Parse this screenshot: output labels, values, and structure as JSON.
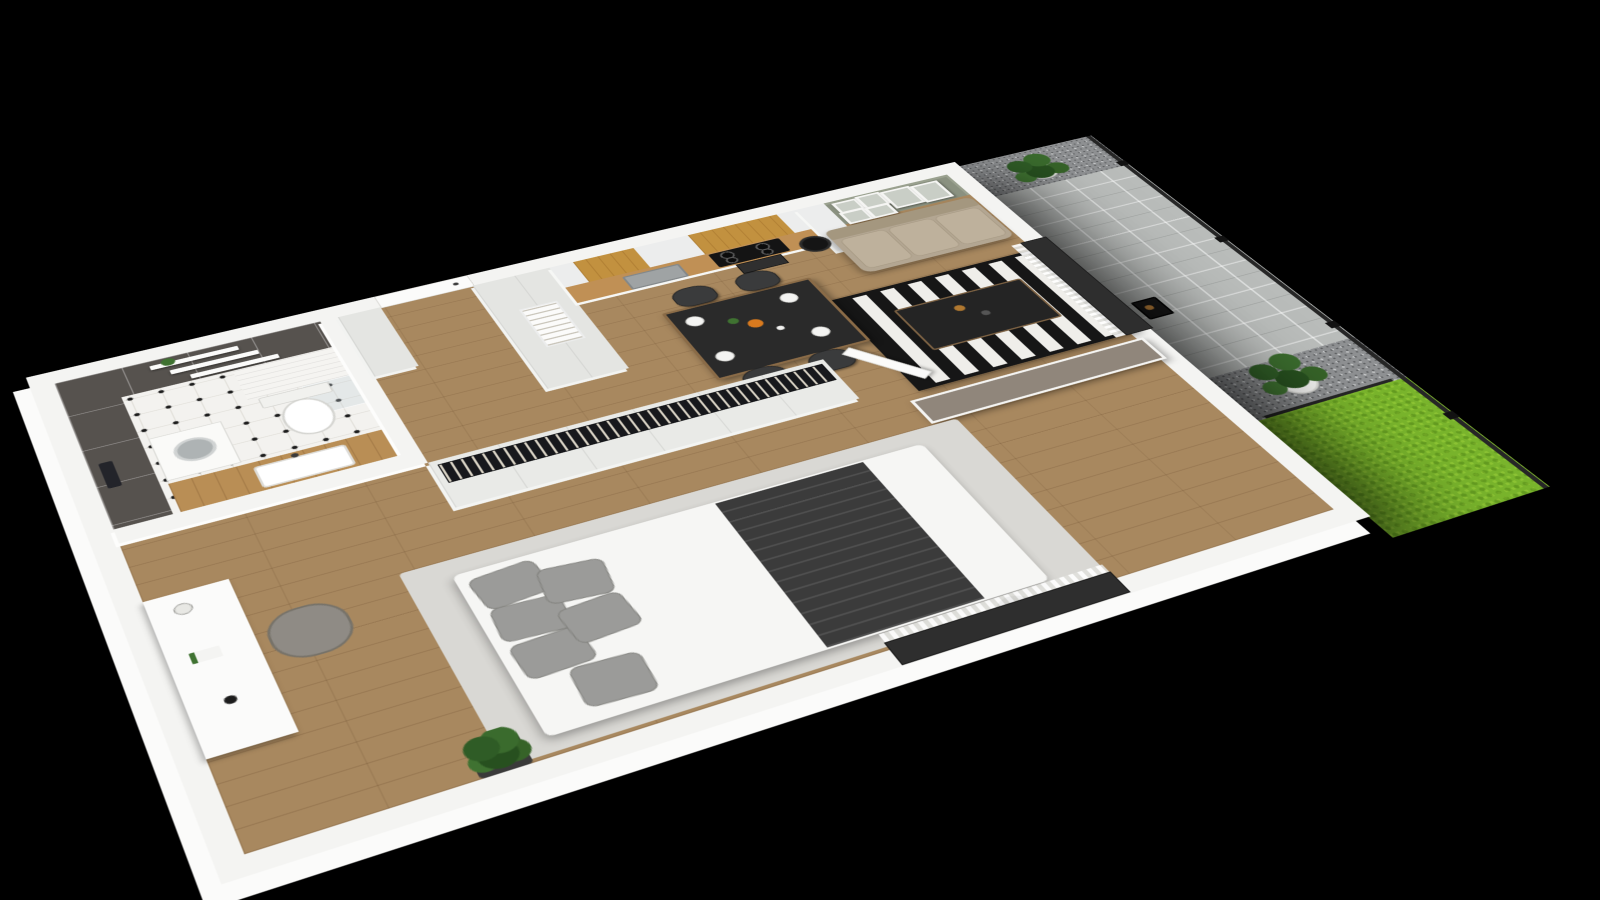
{
  "scene": {
    "type": "3d-isometric-floorplan-render",
    "description": "Photorealistic cutaway 3D floor plan of a one-bedroom apartment with terrace garden, viewed from above at an angle on a black background",
    "background": "#000000"
  },
  "palette": {
    "background_black": "#000000",
    "wall_white": "#f4f4f2",
    "floor_wood": "#a8885f",
    "tile_dark_grey": "#56524e",
    "bath_floor_white": "#f3f2ef",
    "cabinet_white": "#eceded",
    "cabinet_grey": "#e4e5e2",
    "oak_wood": "#c2913f",
    "counter_wood": "#b98e55",
    "sage_green_wall": "#8a9180",
    "sofa_beige": "#b3a692",
    "rug_black": "#161616",
    "rug_white": "#efeeea",
    "dining_charcoal": "#2a2a2a",
    "taupe_partition": "#90867b",
    "bed_linen_white": "#f6f6f4",
    "pillow_grey": "#9b9b99",
    "throw_charcoal": "#3b3b3b",
    "bed_rug_grey": "#d9d8d4",
    "chair_dark_grey": "#3a3b3c",
    "paving_grey": "#b9bcba",
    "gravel_grey": "#8e9092",
    "grass_green": "#79b42c",
    "plant_green": "#2f5c26",
    "pot_white": "#f2f2f0",
    "window_frame_dark": "#2e2e2e",
    "lantern_black": "#191919"
  },
  "rooms": {
    "bathroom": {
      "label": "Bathroom",
      "walls": "dark grey large-format tiles",
      "floor": "white tile with black accent dots",
      "objects": [
        "wall shelves with towels",
        "potted plant on shelf",
        "wall-hung toilet",
        "washing machine",
        "wood vanity countertop with white sink",
        "white tiled shower half-wall with glass screen",
        "black hanging towels"
      ]
    },
    "hallway": {
      "label": "Entrance hall",
      "floor": "wood planks",
      "objects": [
        "white entrance door",
        "tall white storage cabinets",
        "open shelving niche with books"
      ]
    },
    "kitchen": {
      "label": "Kitchen",
      "objects": [
        "white cabinets with oak wood fronts",
        "wood worktop",
        "stainless sink with faucet",
        "black cooktop with four burners",
        "built-in oven",
        "tall fridge cabinet"
      ]
    },
    "dining": {
      "label": "Dining area",
      "objects": [
        "black dining table with wood trim",
        "four dark grey upholstered chairs",
        "set plates",
        "bowl of oranges",
        "flower sprig",
        "carafe"
      ]
    },
    "living_room": {
      "label": "Living room",
      "objects": [
        "sage green accent wall",
        "gallery wall of six framed botanical prints",
        "beige three-seat sofa",
        "black floor lamp",
        "black and white striped rug",
        "dark coffee table with decor",
        "window to terrace with sheer curtains"
      ]
    },
    "bedroom": {
      "label": "Bedroom",
      "objects": [
        "open-top wardrobe with clothes on hanger rail",
        "white panelled wardrobe doors",
        "open white interior door",
        "taupe partition wall",
        "double bed with white linen",
        "grey pillows",
        "charcoal throw blanket",
        "light grey area rug",
        "black bedside lamp",
        "white desk with lamp, book and cup",
        "grey armchair",
        "potted plant on dark stool",
        "window to garden with sheer curtain"
      ]
    },
    "terrace": {
      "label": "Terrace and garden",
      "objects": [
        "grey stone paving slabs",
        "dark gravel strips",
        "bright green lawn",
        "potted palm in white planter",
        "potted ficus tree in white planter",
        "black candle lantern",
        "dark mesh garden fence with posts"
      ]
    }
  }
}
